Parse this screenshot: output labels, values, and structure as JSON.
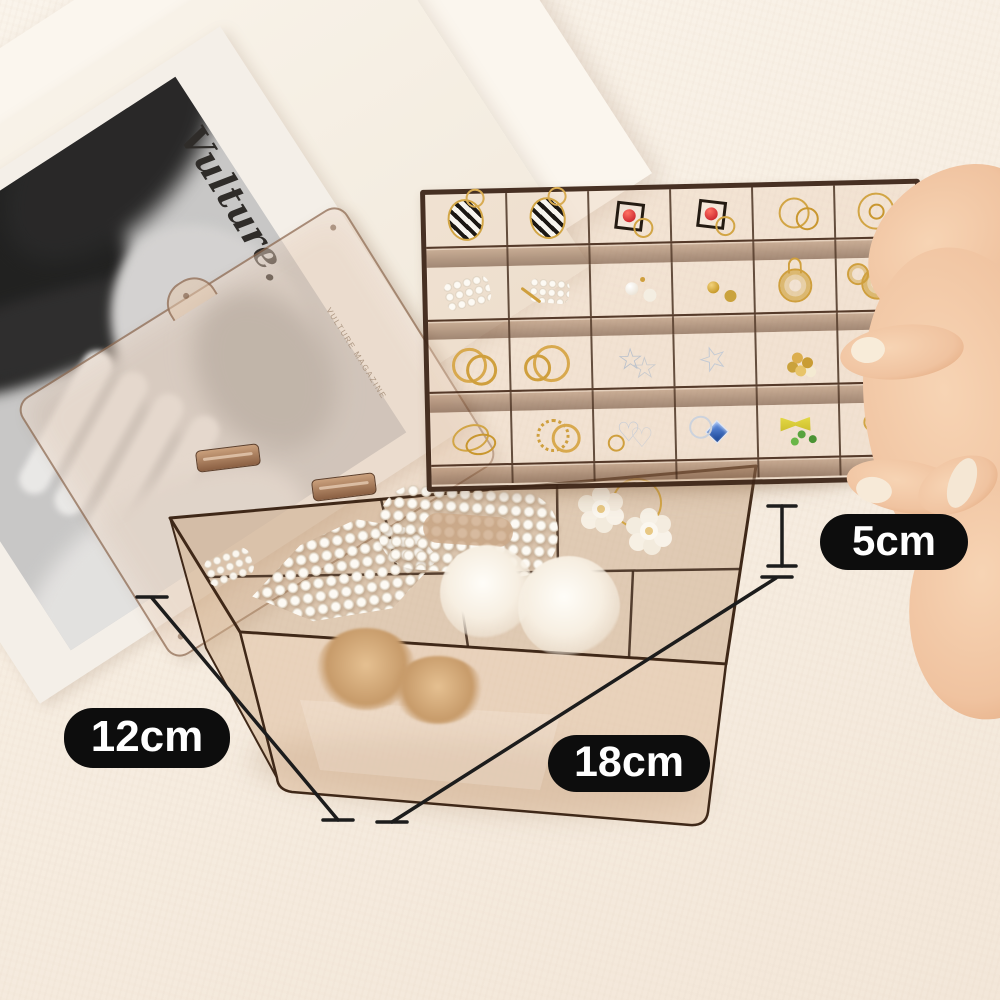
{
  "scene": {
    "name": "transparent-amber-jewelry-organizer-product-photo",
    "background_top": "#f9f2e9",
    "background_bottom": "#f3e7d9"
  },
  "magazine": {
    "masthead": "Vulture.",
    "caption": "VULTURE MAGAZINE"
  },
  "annotations": {
    "badge_bg": "#0d0d0d",
    "badge_text_color": "#ffffff",
    "line_color": "#1c1c1c",
    "height": {
      "label": "5cm"
    },
    "width": {
      "label": "12cm"
    },
    "length": {
      "label": "18cm"
    }
  },
  "materials": {
    "amber_fill": "rgba(196,158,120,0.45)",
    "amber_edge": "#3f2818",
    "gold": "#cf9f3d",
    "silver": "#c6ccd6",
    "pearl": "#f6f1ea",
    "skin": "#f2c6a2"
  },
  "tray": {
    "rows": 4,
    "cols": 6,
    "cells": [
      {
        "name": "striped-hoop-earring",
        "glyph": "striped"
      },
      {
        "name": "striped-hoop-earring",
        "glyph": "striped"
      },
      {
        "name": "red-bead-square-earrings",
        "glyph": "redsq"
      },
      {
        "name": "red-bead-square-earrings",
        "glyph": "redsq"
      },
      {
        "name": "gold-hoop-earrings",
        "glyph": "hoops"
      },
      {
        "name": "gold-double-hoop-earrings",
        "glyph": "hoops2"
      },
      {
        "name": "pearl-strand",
        "glyph": "pearls"
      },
      {
        "name": "pearl-pin-earrings",
        "glyph": "pearlpins"
      },
      {
        "name": "pearl-stud-earrings",
        "glyph": "pearlstuds"
      },
      {
        "name": "gold-knot-studs",
        "glyph": "knots"
      },
      {
        "name": "gold-wire-ball-earring",
        "glyph": "wireball"
      },
      {
        "name": "gold-wire-ball-earrings",
        "glyph": "wireball2"
      },
      {
        "name": "gold-rings",
        "glyph": "rings"
      },
      {
        "name": "gold-round-hoops",
        "glyph": "rings2"
      },
      {
        "name": "silver-star-earrings",
        "glyph": "star"
      },
      {
        "name": "silver-star-earring",
        "glyph": "star2"
      },
      {
        "name": "gold-pearl-cluster-earrings",
        "glyph": "cluster"
      },
      {
        "name": "gold-flower-earrings",
        "glyph": "flowerg"
      },
      {
        "name": "gold-oval-hoops",
        "glyph": "ovals"
      },
      {
        "name": "gold-twist-rings",
        "glyph": "twist"
      },
      {
        "name": "silver-heart-earrings",
        "glyph": "hearts"
      },
      {
        "name": "blue-crystal-heart-ring",
        "glyph": "bluegem"
      },
      {
        "name": "yellow-bow-earrings",
        "glyph": "bow"
      },
      {
        "name": "green-flower-earrings",
        "glyph": "greenfl"
      }
    ]
  },
  "box": {
    "contents": [
      {
        "name": "pearl-hair-clip"
      },
      {
        "name": "pearl-hair-clip"
      },
      {
        "name": "loose-pearls"
      },
      {
        "name": "pearl-flower-hair-ties"
      },
      {
        "name": "white-fur-pompom"
      },
      {
        "name": "white-fur-pompom"
      },
      {
        "name": "tan-fur-scrunchie"
      },
      {
        "name": "tan-fur-scrunchie"
      }
    ]
  }
}
